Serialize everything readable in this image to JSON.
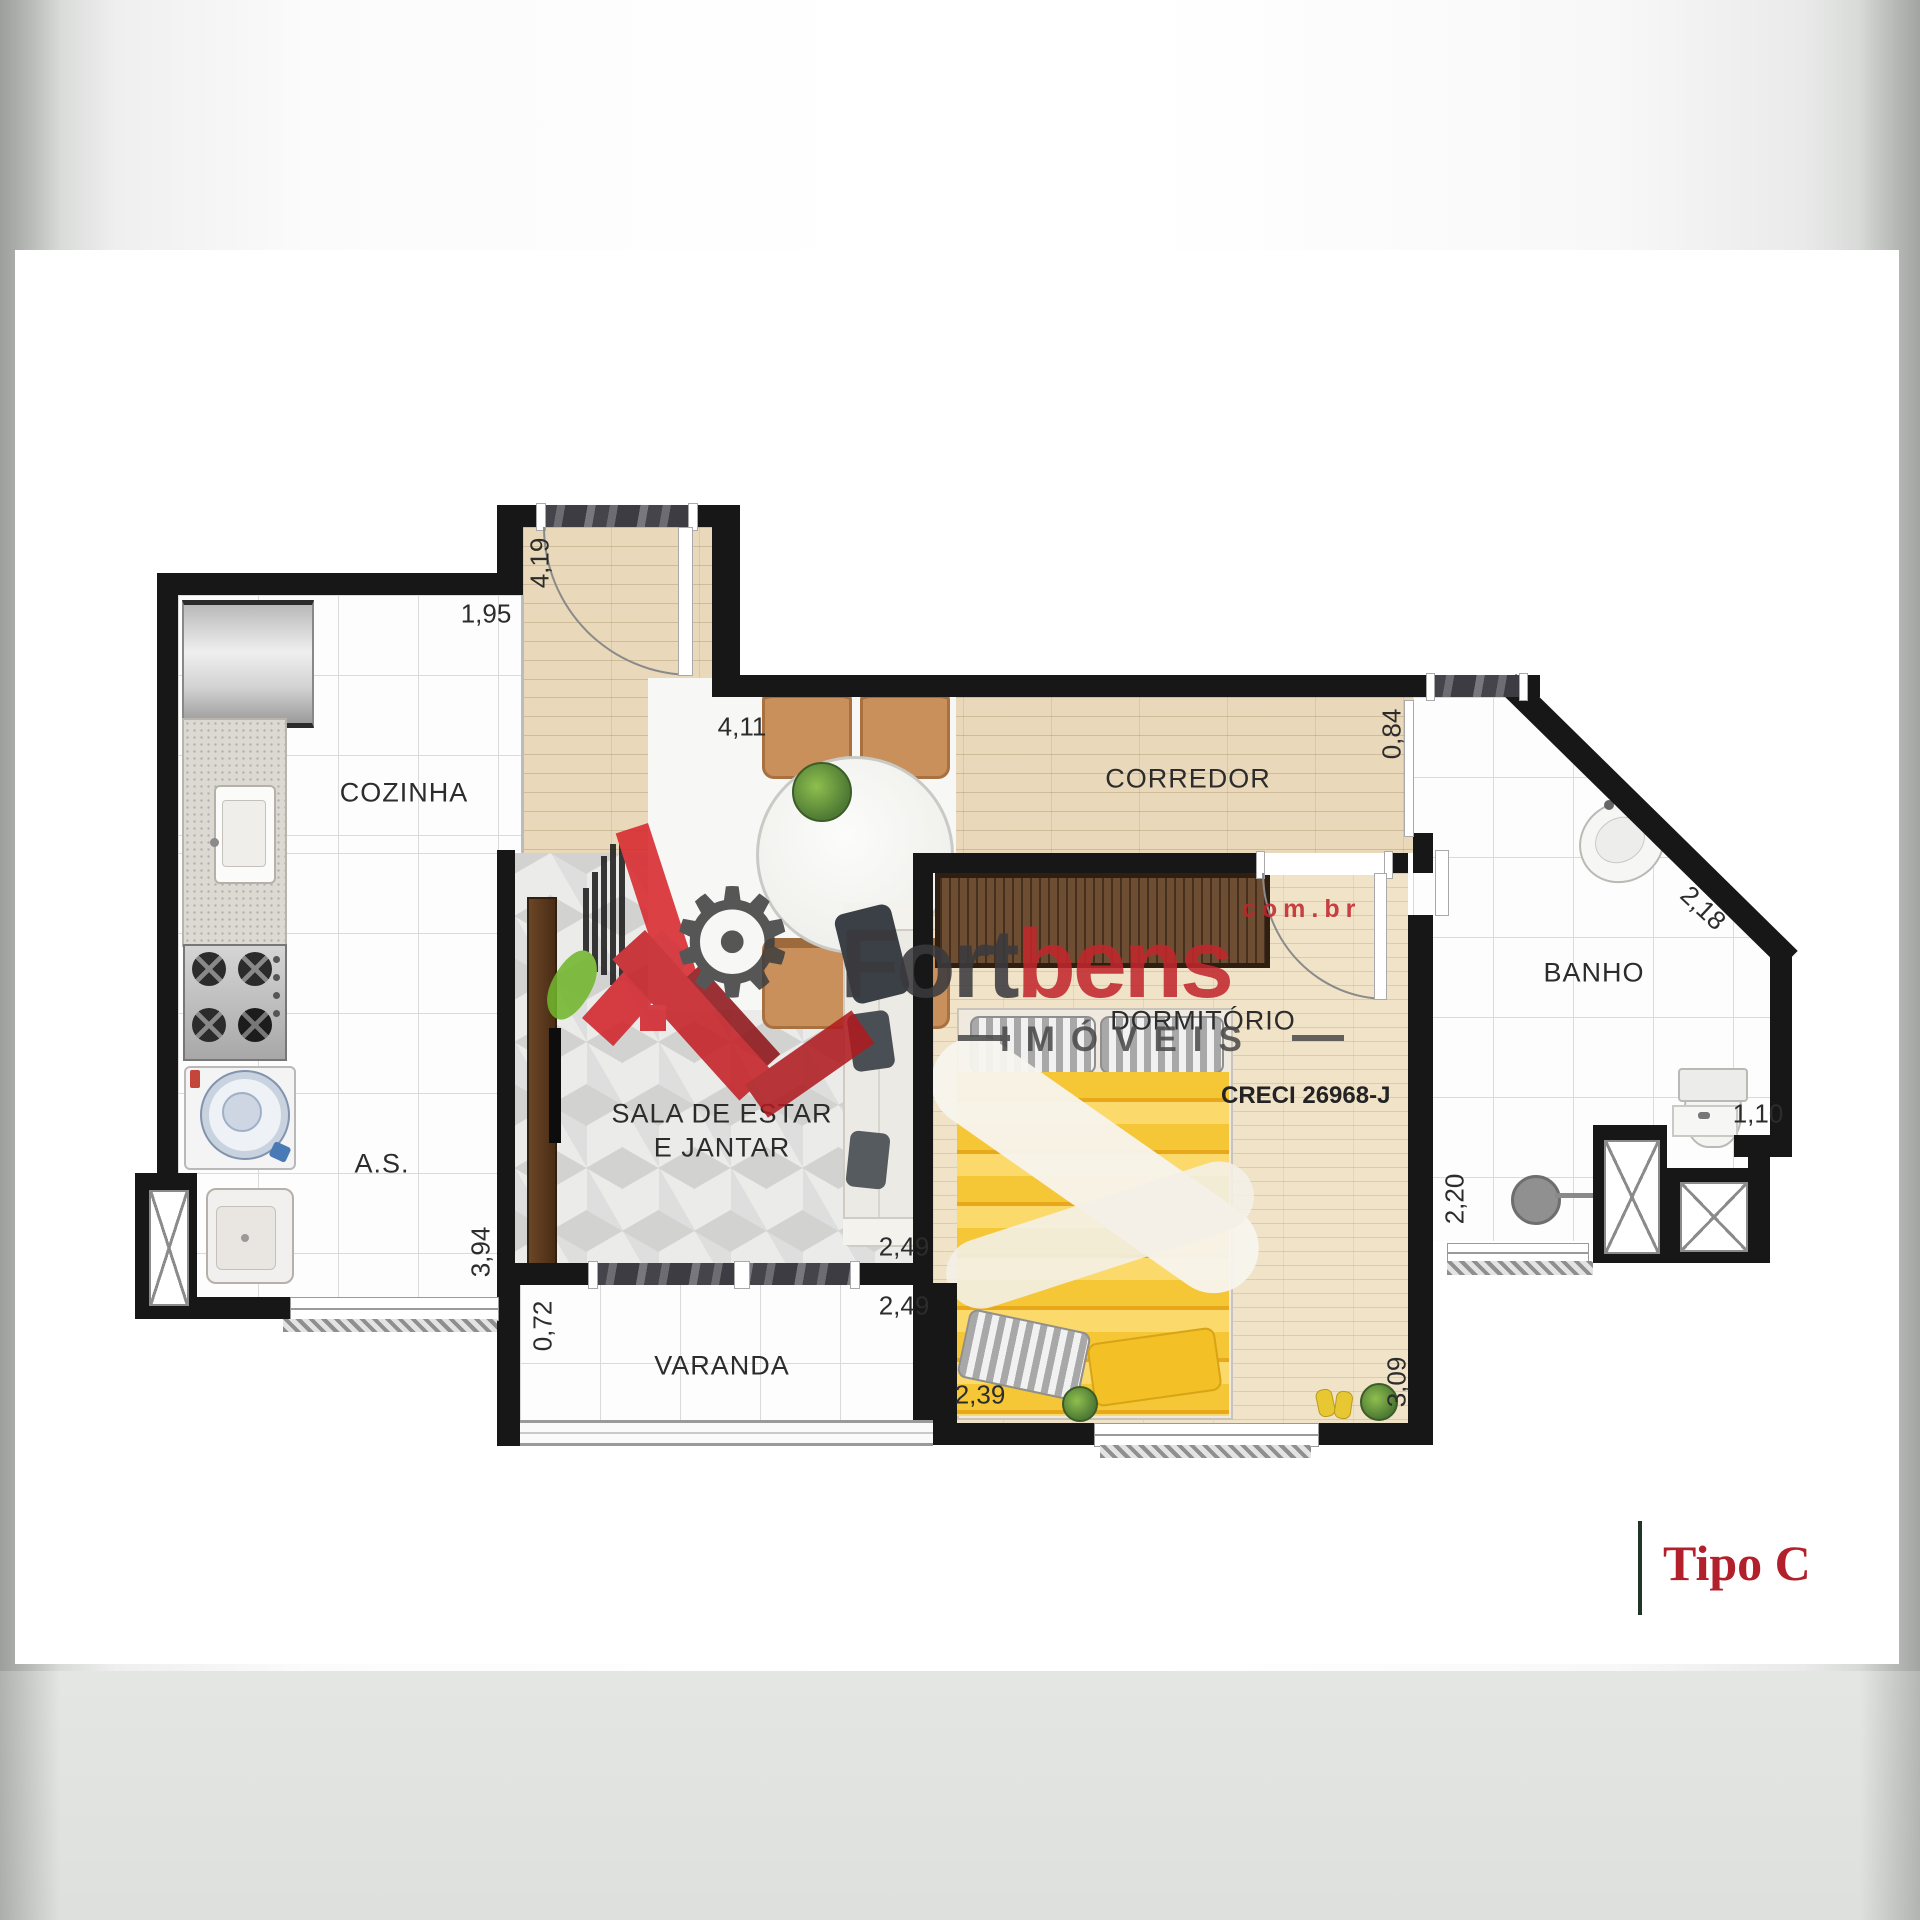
{
  "variant": {
    "label": "Tipo C"
  },
  "watermark": {
    "brand_first": "Fort",
    "brand_second": "bens",
    "domain": "com.br",
    "subtitle": "IMÓVEIS",
    "creci": "CRECI 26968-J"
  },
  "rooms": {
    "cozinha": "COZINHA",
    "corredor": "CORREDOR",
    "banho": "BANHO",
    "servico": "A.S.",
    "sala_line1": "SALA DE ESTAR",
    "sala_line2": "E JANTAR",
    "dormitorio": "DORMITÓRIO",
    "varanda": "VARANDA"
  },
  "dimensions": {
    "kitchen_wall": "1,95",
    "entry_depth": "4,19",
    "hall_width": "4,11",
    "corridor_width": "0,84",
    "banho_diagonal": "2,18",
    "banho_niche": "1,10",
    "banho_depth": "2,20",
    "servico_depth": "3,94",
    "varanda_depth": "0,72",
    "sala_width": "2,49",
    "varanda_width": "2,49",
    "dorm_width": "2,39",
    "dorm_depth": "3,09"
  },
  "colors": {
    "brand_dark": "#3a3a3e",
    "brand_red": "#c1272d",
    "tipo_red": "#b2202b",
    "frame_green": "#203428",
    "wall_black": "#171717",
    "blanket_yellow": "#f2c235"
  }
}
